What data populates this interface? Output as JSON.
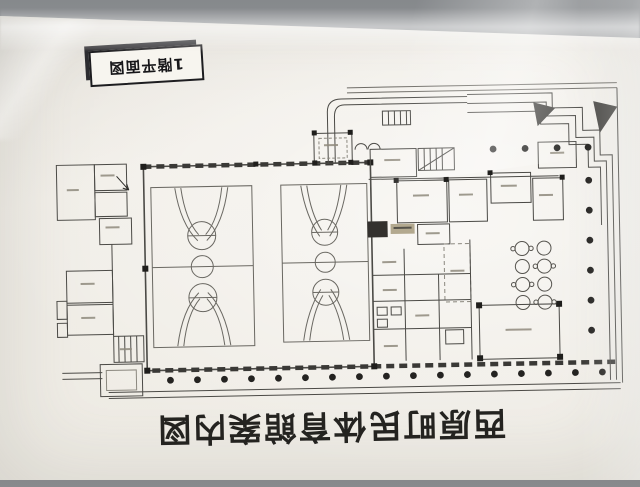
{
  "badge": {
    "label": "1階平面図"
  },
  "title": {
    "text": "西原町民体育館案内図"
  },
  "floor_plan": {
    "basketball_courts": 2
  },
  "colors": {
    "wall": "#a7aaac",
    "paper": "#f1eee7",
    "ink": "#4b4a46",
    "title_ink": "#242320",
    "badge_shadow": "#2c2c30"
  }
}
